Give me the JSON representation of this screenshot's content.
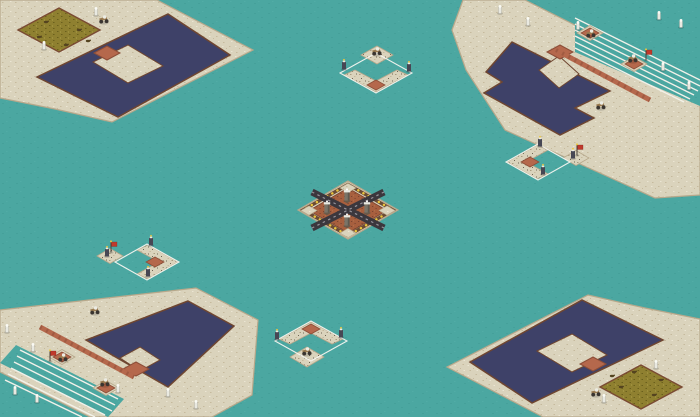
{
  "scene": {
    "type": "isometric-city-builder-map",
    "colors": {
      "water": "#4BA7A1",
      "water_shade": "#45A09A",
      "water_light": "#52ACA6",
      "sand": "#DAD3BC",
      "sand_speck": "#C6BA9D",
      "sand_light": "#EBE5D3",
      "sand_edge": "#B7A88B",
      "pool": "#3E4168",
      "pool_border": "#6F4631",
      "farm": "#8F8030",
      "farm_speck": "#6A5F1D",
      "farm_light": "#ACA04A",
      "farm_border": "#7A4A33",
      "plaza": "#B5684C",
      "plaza_edge": "#8C4E38",
      "road": "#B5684C",
      "road_dash": "#8C4E38",
      "quad_red": "#A75F3E",
      "quad_speck": "#7C4531",
      "quad_light": "#B97A55",
      "cross_road": "#3B373D",
      "cross_dash": "#97949B",
      "gold": "#ECC63C",
      "gold_edge": "#6B4B34",
      "outline_white": "#F5F5F0",
      "pier": "#F2F1E9",
      "ruin_gray": "#A99C80",
      "banner_red": "#C0392B",
      "sprite_dark": "#474754",
      "sprite_light": "#E9E9E1"
    },
    "islands": [
      {
        "id": "top-left",
        "kind": "pool-island",
        "features": [
          "navy-pool",
          "farm-field",
          "plaza-square",
          "statues",
          "animals"
        ]
      },
      {
        "id": "top-right",
        "kind": "dock-island",
        "features": [
          "navy-pool",
          "pier-lines",
          "road",
          "dock-platforms",
          "banner",
          "catapults"
        ]
      },
      {
        "id": "bottom-left",
        "kind": "dock-island",
        "features": [
          "navy-pool",
          "pier-lines",
          "road",
          "dock-platforms",
          "banner",
          "catapults"
        ]
      },
      {
        "id": "bottom-right",
        "kind": "pool-island",
        "features": [
          "navy-pool",
          "farm-field",
          "plaza-square",
          "statues",
          "animals"
        ]
      },
      {
        "id": "north-outpost",
        "kind": "outpost",
        "features": [
          "white-zone-outline",
          "ruin-platform",
          "plaza-square",
          "catapult"
        ]
      },
      {
        "id": "east-outpost",
        "kind": "outpost",
        "features": [
          "white-zone-outline",
          "ruin-platform",
          "plaza-square",
          "flag-shrine"
        ]
      },
      {
        "id": "west-outpost",
        "kind": "outpost",
        "features": [
          "white-zone-outline",
          "ruin-platform",
          "plaza-square",
          "flag-shrine"
        ]
      },
      {
        "id": "south-outpost",
        "kind": "outpost",
        "features": [
          "white-zone-outline",
          "ruin-platform",
          "plaza-square",
          "catapult"
        ]
      },
      {
        "id": "central",
        "kind": "fortress",
        "features": [
          "gold-dot-perimeter",
          "cross-roads",
          "four-towers",
          "red-quadrants"
        ]
      }
    ],
    "counts": {
      "corner_islands": 4,
      "outposts": 4,
      "central_towers": 4,
      "pier_lines_per_dock": 6,
      "farm_fields": 2
    }
  }
}
